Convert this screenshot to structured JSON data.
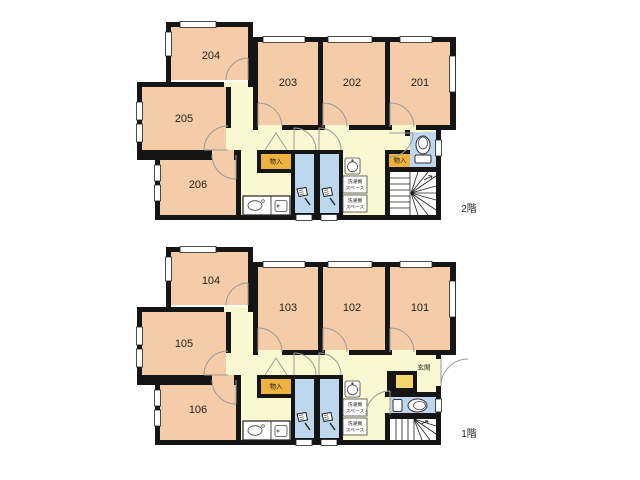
{
  "colors": {
    "wall": "#151515",
    "room": "#F5CCA8",
    "corridor": "#FAF8D0",
    "wet": "#BDD7EE",
    "storage": "#F0B23E",
    "shoe": "#F5D469"
  },
  "floor2": {
    "label": "2階",
    "rooms": [
      "201",
      "202",
      "203",
      "204",
      "205",
      "206"
    ],
    "storage_label": "物入",
    "laundry_line1": "洗濯機",
    "laundry_line2": "スペース"
  },
  "floor1": {
    "label": "1階",
    "rooms": [
      "101",
      "102",
      "103",
      "104",
      "105",
      "106"
    ],
    "storage_label": "物入",
    "entrance_label": "玄関",
    "laundry_line1": "洗濯機",
    "laundry_line2": "スペース"
  },
  "icons": {
    "shower": "shower-icon",
    "toilet": "toilet-icon",
    "kitchen_sink": "kitchen-sink-icon",
    "washbasin": "washbasin-icon",
    "stairs": "stairs"
  }
}
